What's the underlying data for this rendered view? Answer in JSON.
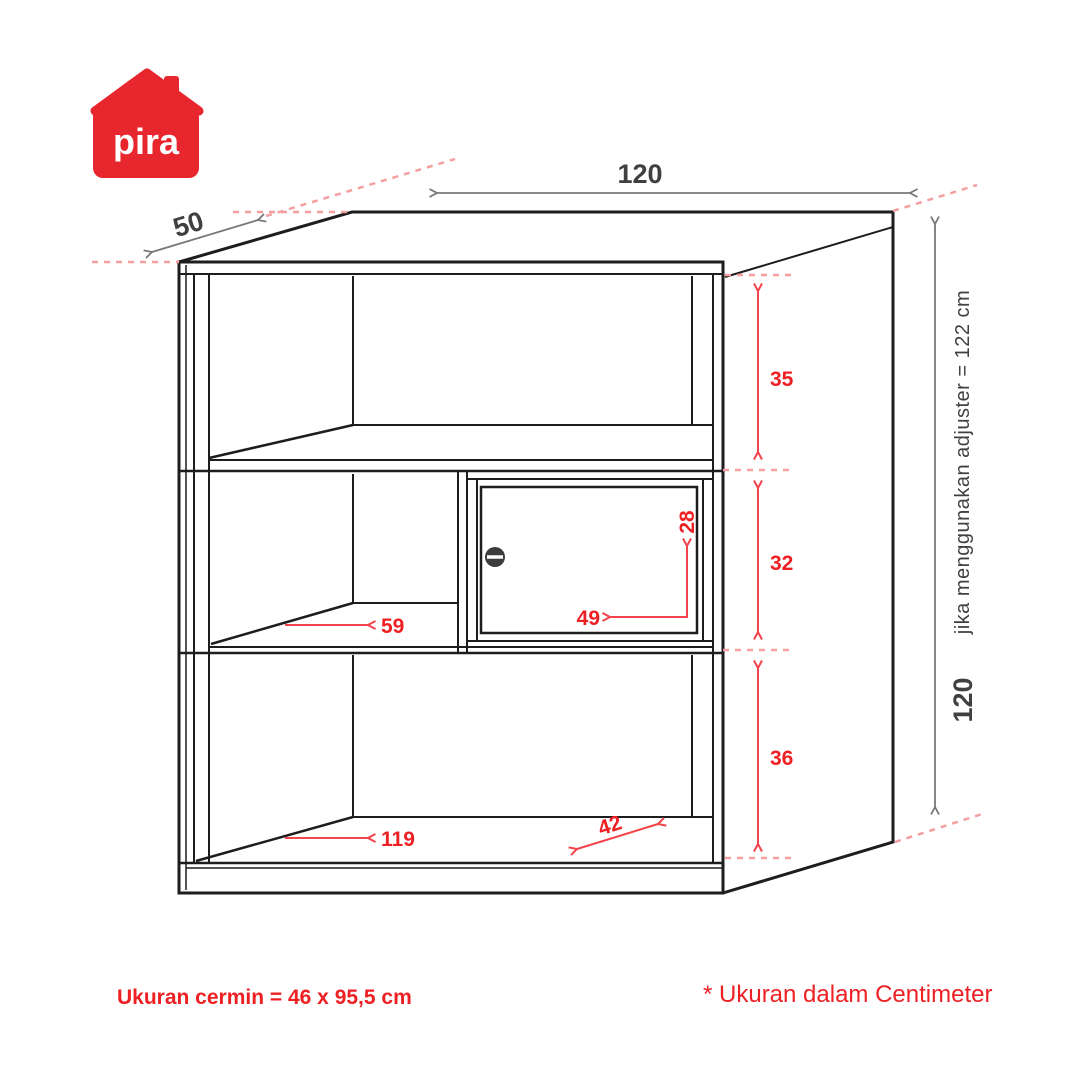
{
  "logo": {
    "text": "pira"
  },
  "diagram": {
    "top_width": "120",
    "depth": "50",
    "right_sections": {
      "top": "35",
      "middle": "32",
      "bottom": "36"
    },
    "total_height": "120",
    "adjuster_note": "jika menggunakan adjuster = 122 cm",
    "interior": {
      "shelf_width": "59",
      "door_width": "49",
      "door_height": "28",
      "bottom_width": "119",
      "bottom_depth": "42"
    }
  },
  "footnotes": {
    "mirror_size": "Ukuran cermin = 46 x 95,5 cm",
    "unit_note": "* Ukuran dalam Centimeter"
  },
  "colors": {
    "logo_red": "#e8262d",
    "accent_red": "#ed2024",
    "arrow_red": "#f2444a",
    "dashed_pink": "#f59fa1",
    "line_black": "#1d1d1f",
    "dim_gray": "#77787b",
    "text_dark": "#3f4042"
  }
}
